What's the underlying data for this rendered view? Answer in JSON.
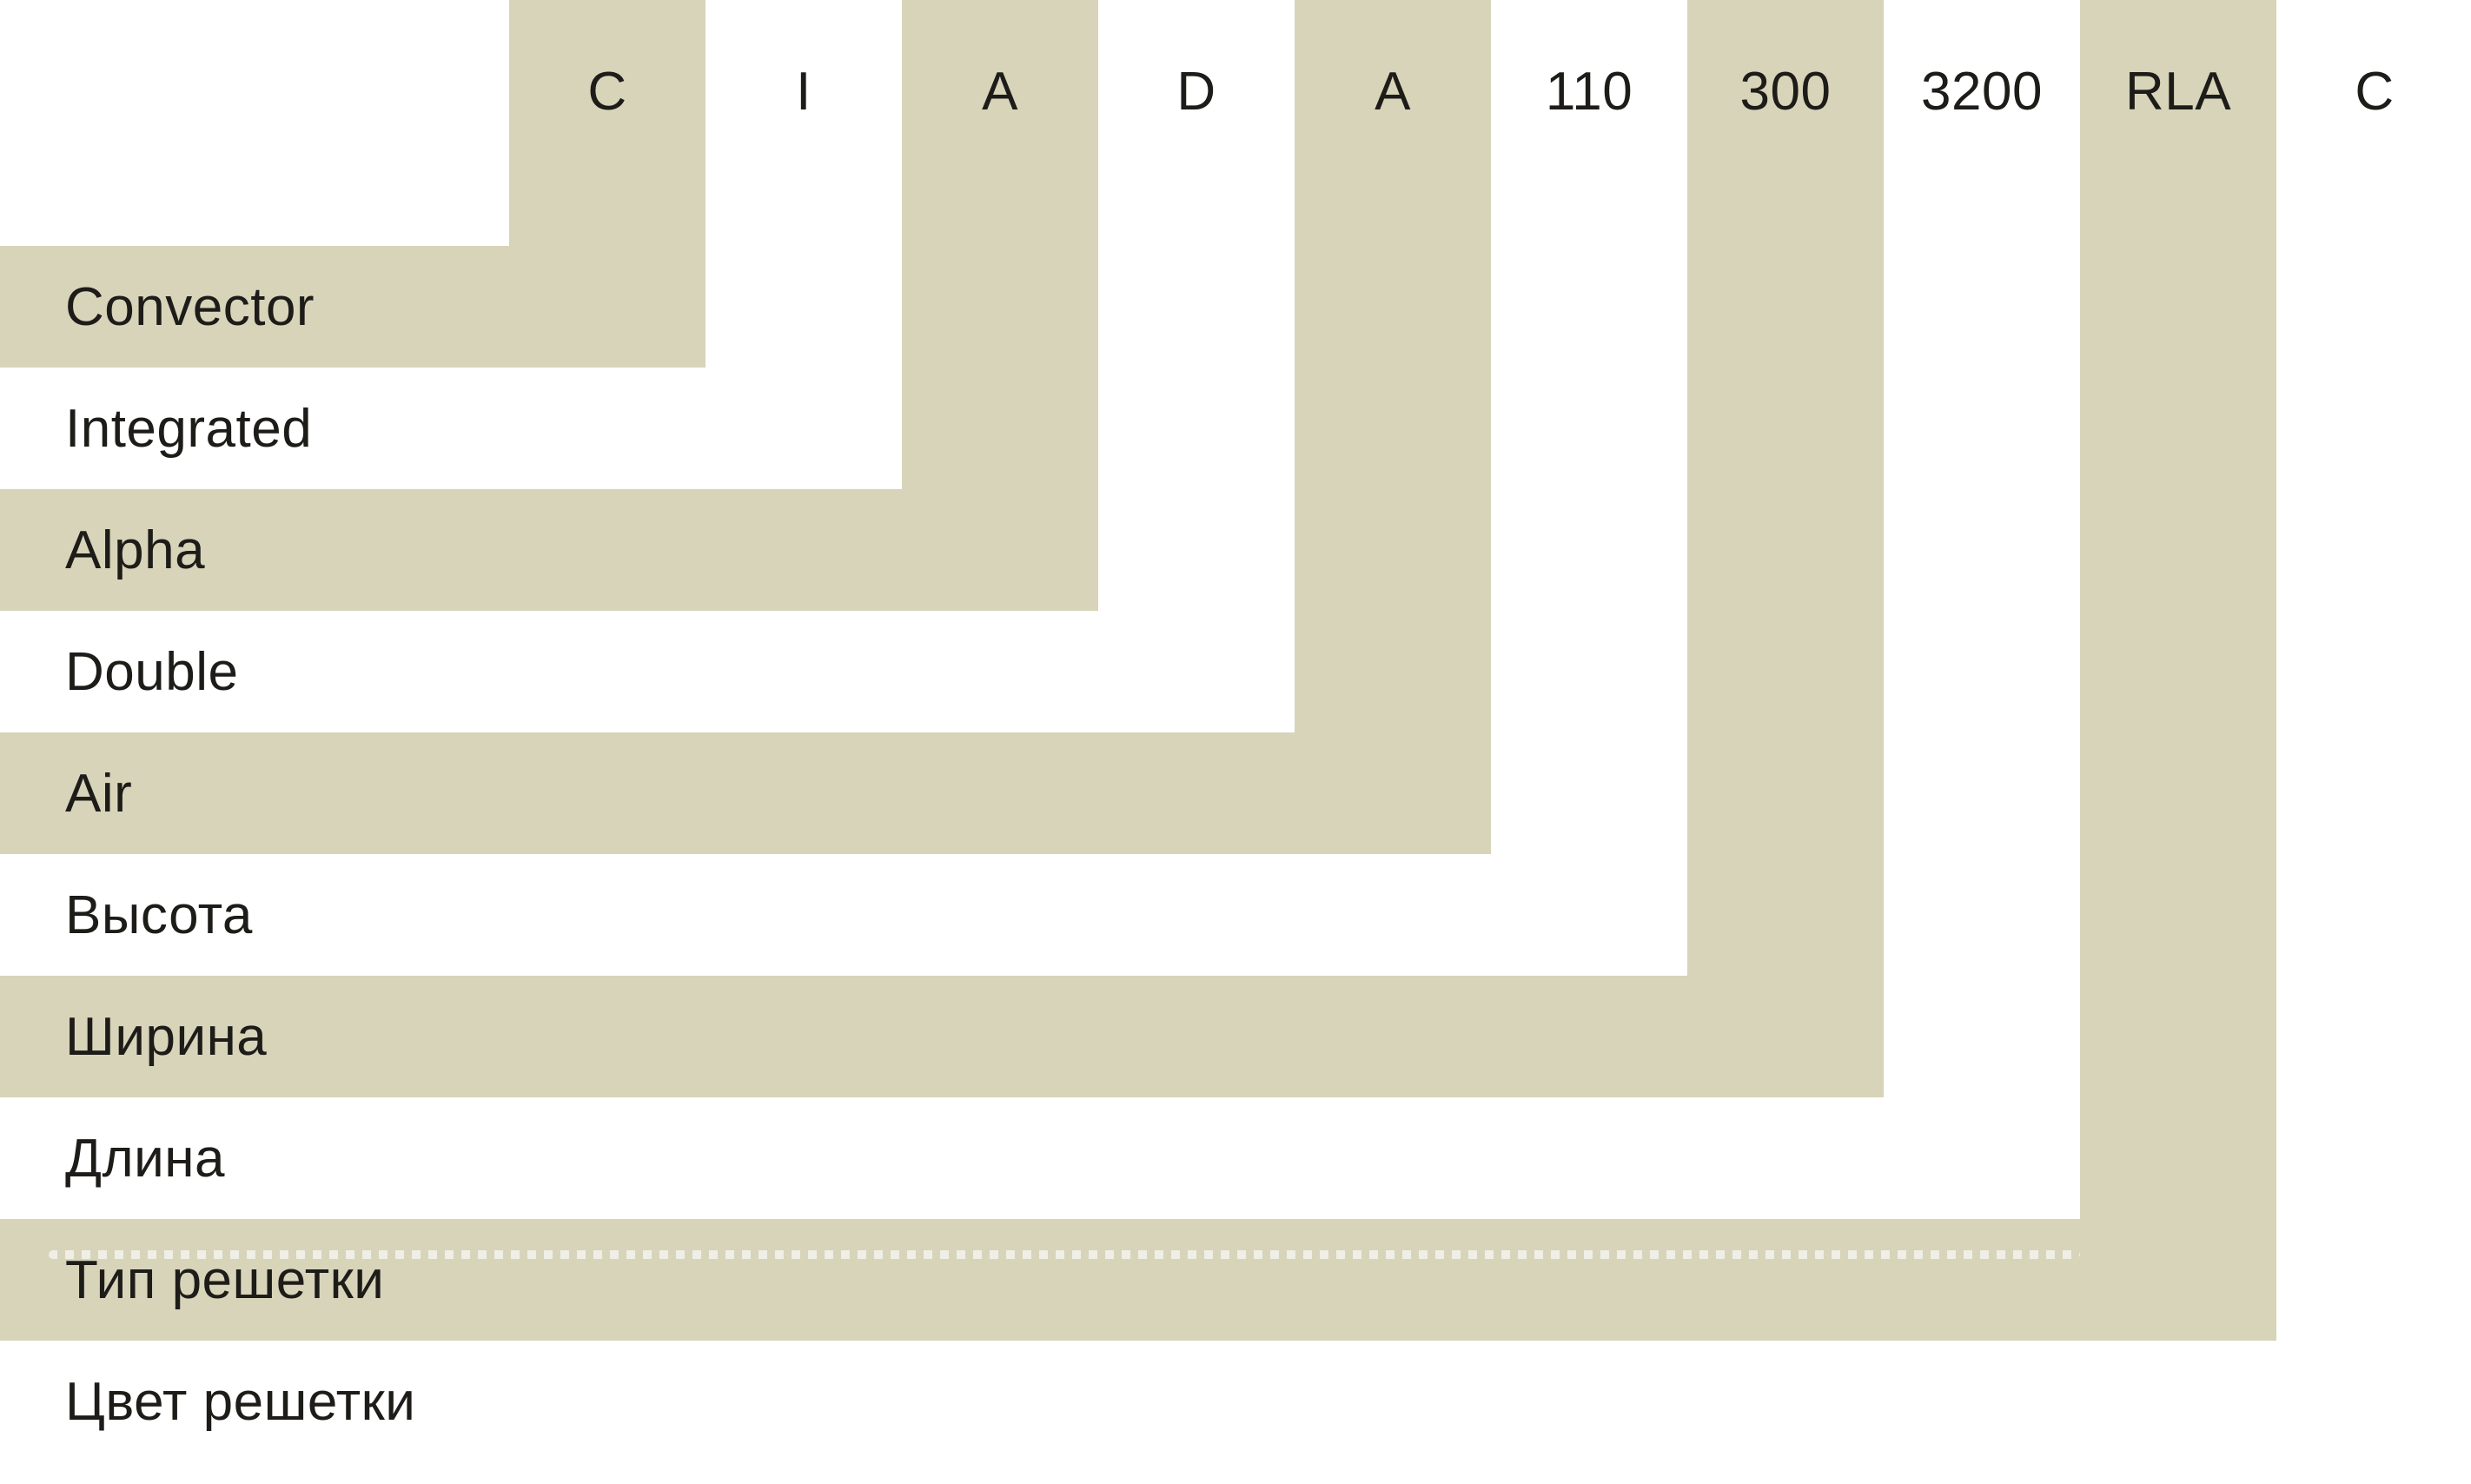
{
  "colors": {
    "background": "#ffffff",
    "stripe": "#d7d4ba",
    "text": "#1d1c18",
    "dotted_line": "rgba(255,255,255,0.62)"
  },
  "columns": [
    {
      "code": "C",
      "shaded": true
    },
    {
      "code": "I",
      "shaded": false
    },
    {
      "code": "A",
      "shaded": true
    },
    {
      "code": "D",
      "shaded": false
    },
    {
      "code": "A",
      "shaded": true
    },
    {
      "code": "110",
      "shaded": false
    },
    {
      "code": "300",
      "shaded": true
    },
    {
      "code": "3200",
      "shaded": false
    },
    {
      "code": "RLA",
      "shaded": true
    },
    {
      "code": "C",
      "shaded": false
    }
  ],
  "rows": [
    {
      "label": "Convector",
      "code": "C",
      "shaded": true,
      "dotted": false
    },
    {
      "label": "Integrated",
      "code": "I",
      "shaded": false,
      "dotted": false
    },
    {
      "label": "Alpha",
      "code": "A",
      "shaded": true,
      "dotted": false
    },
    {
      "label": "Double",
      "code": "D",
      "shaded": false,
      "dotted": false
    },
    {
      "label": "Air",
      "code": "A",
      "shaded": true,
      "dotted": false
    },
    {
      "label": "Высота",
      "code": "110",
      "shaded": false,
      "dotted": false
    },
    {
      "label": "Ширина",
      "code": "300",
      "shaded": true,
      "dotted": false
    },
    {
      "label": "Длина",
      "code": "3200",
      "shaded": false,
      "dotted": false
    },
    {
      "label": "Тип решетки",
      "code": "RLA",
      "shaded": true,
      "dotted": true
    },
    {
      "label": "Цвет решетки",
      "code": "C",
      "shaded": false,
      "dotted": false
    }
  ]
}
